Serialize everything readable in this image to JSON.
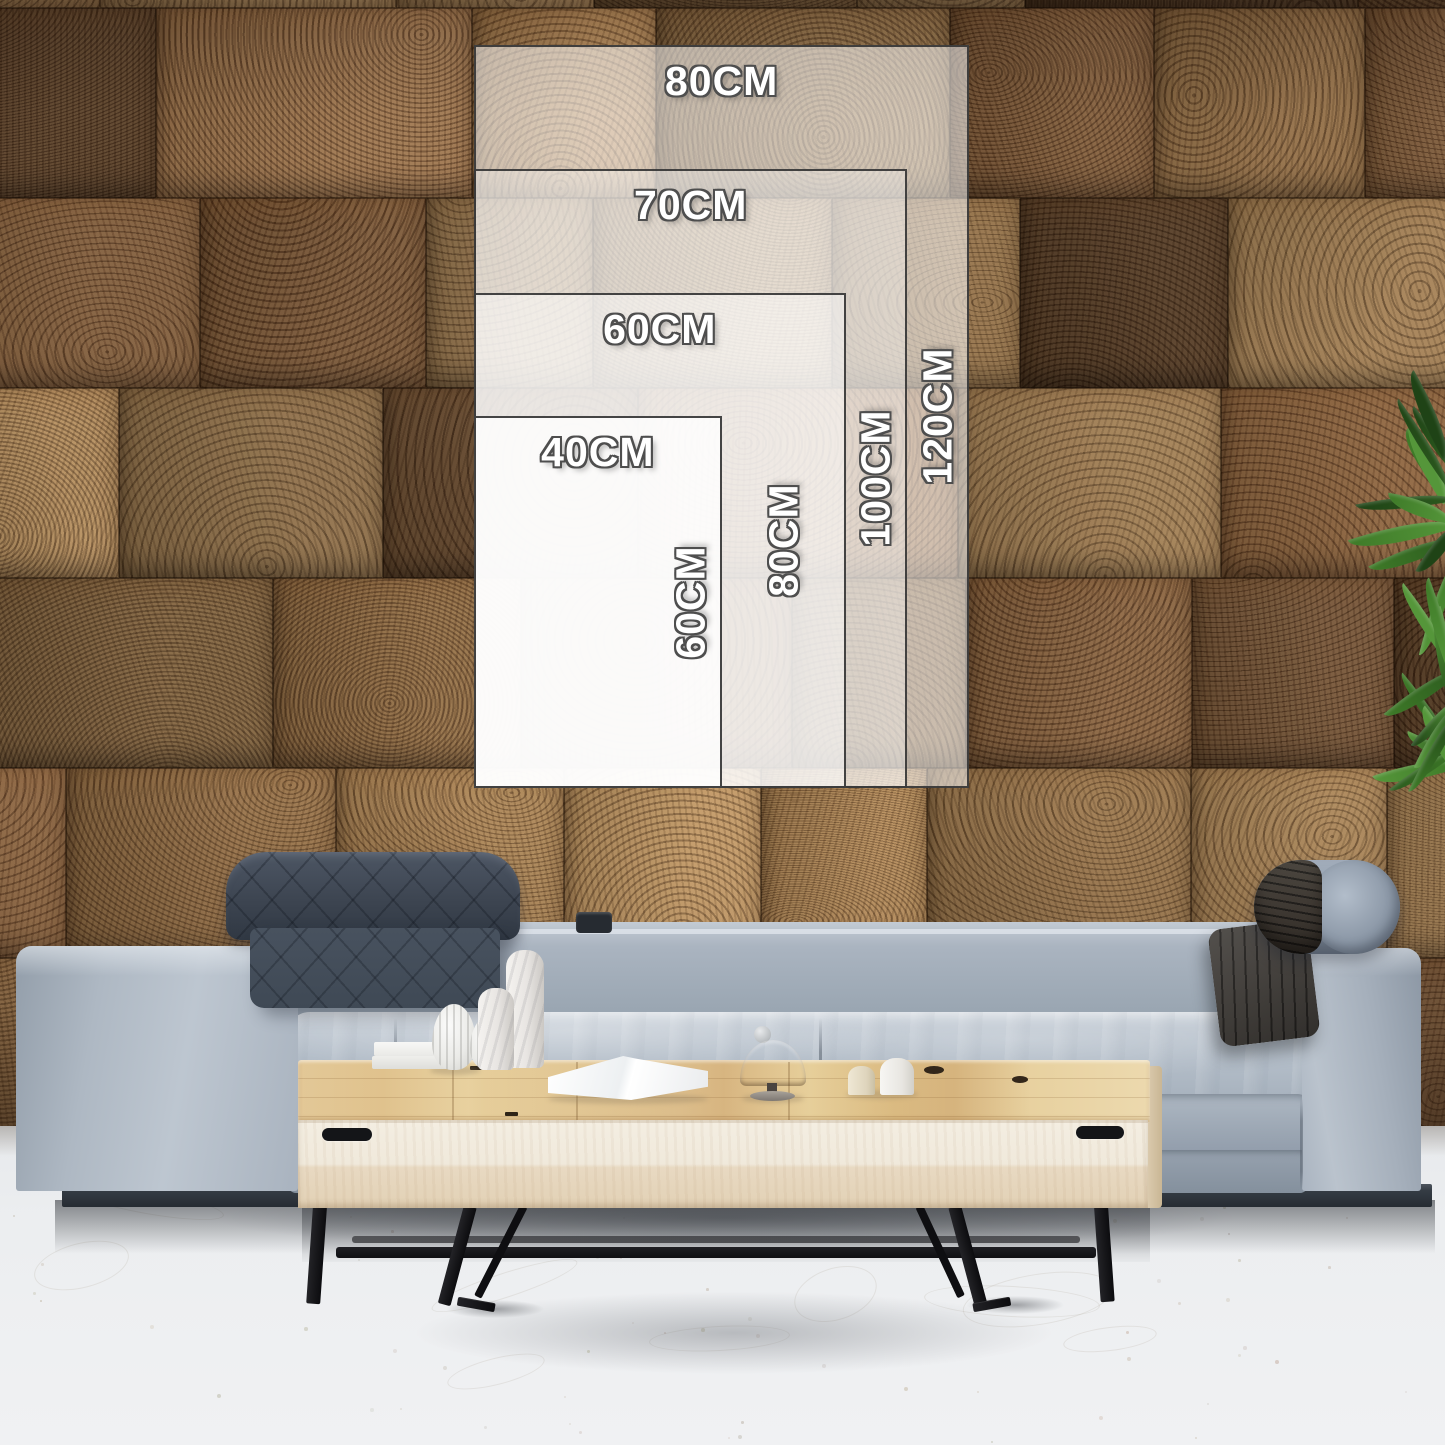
{
  "size_guide": {
    "unit": "CM",
    "layout": "nested panels aligned bottom-left",
    "sizes": [
      {
        "id": "80x120",
        "width_cm": 80,
        "height_cm": 120,
        "width_label": "80CM",
        "height_label": "120CM"
      },
      {
        "id": "70x100",
        "width_cm": 70,
        "height_cm": 100,
        "width_label": "70CM",
        "height_label": "100CM"
      },
      {
        "id": "60x80",
        "width_cm": 60,
        "height_cm": 80,
        "width_label": "60CM",
        "height_label": "80CM"
      },
      {
        "id": "40x60",
        "width_cm": 40,
        "height_cm": 60,
        "width_label": "40CM",
        "height_label": "60CM"
      }
    ],
    "panel_fill_color": "#ffffff",
    "panel_border_color": "#343434",
    "label_text_color": "#ffffff",
    "label_outline_color": "#4e4e4e"
  },
  "scene": {
    "description": "Living room: end-grain wood block wall, light gray fabric sofa with quilted headrest and bolster, pale wood coffee table on black metal sled legs, white decor objects, green plant leaves at right edge",
    "wall_palette": [
      "#6f4c2e",
      "#7d5938",
      "#8a653d",
      "#5c3e25",
      "#96744a",
      "#54371f",
      "#7a5230",
      "#a07c50",
      "#684629",
      "#8d6a41"
    ],
    "plant_leaf_colors": [
      "#1f4316",
      "#2c5a1e",
      "#3e7a28",
      "#55963a"
    ],
    "floor_color": "#eceef0",
    "sofa_fabric_color": "#aab4c0",
    "sofa_plinth_color": "#30373e",
    "headrest_quilted_color": "#46505d",
    "headrest_bolster_wrap_color": "#37342f",
    "table_wood_color": "#ecd9ab",
    "table_front_color": "#f0e9dc",
    "table_leg_color": "#1a1a1d"
  }
}
